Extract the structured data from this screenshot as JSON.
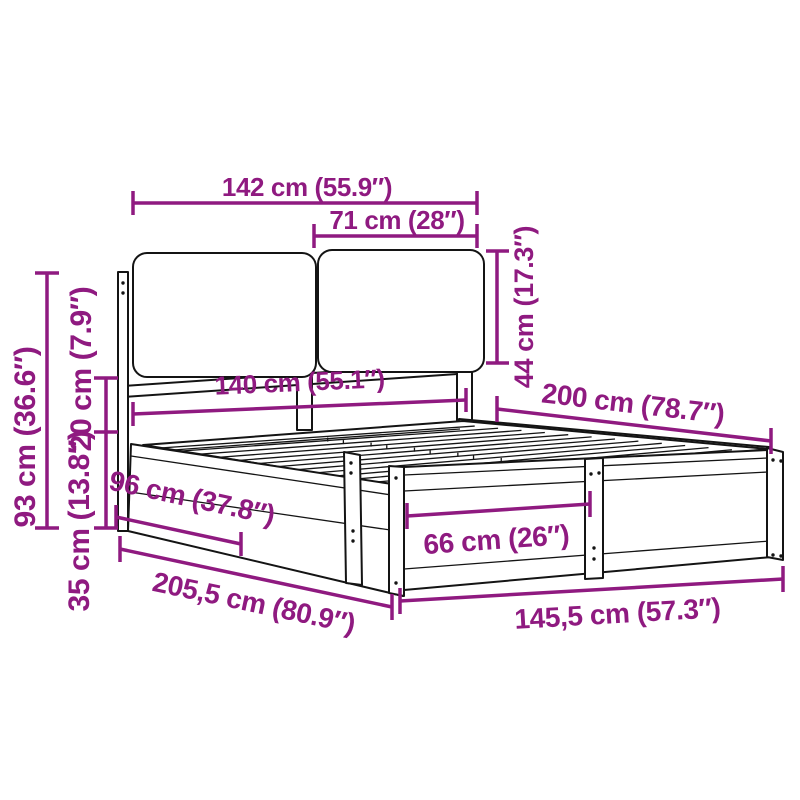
{
  "title": "Bed frame with cushioned headboard — dimension diagram",
  "accent_color": "#8F1A80",
  "ink_color": "#141414",
  "dimensions": {
    "headboard_width": "142 cm (55.9″)",
    "cushion_width": "71 cm (28″)",
    "cushion_height": "44 cm (17.3″)",
    "mattress_width": "140 cm (55.1″)",
    "mattress_length": "200 cm (78.7″)",
    "headboard_height": "93 cm (36.6″)",
    "headboard_gap_height": "20 cm (7.9″)",
    "frame_height": "35 cm (13.8″)",
    "side_panel_length": "96 cm (37.8″)",
    "foot_panel_length": "66 cm (26″)",
    "total_length": "205,5 cm (80.9″)",
    "total_width": "145,5 cm (57.3″)"
  }
}
